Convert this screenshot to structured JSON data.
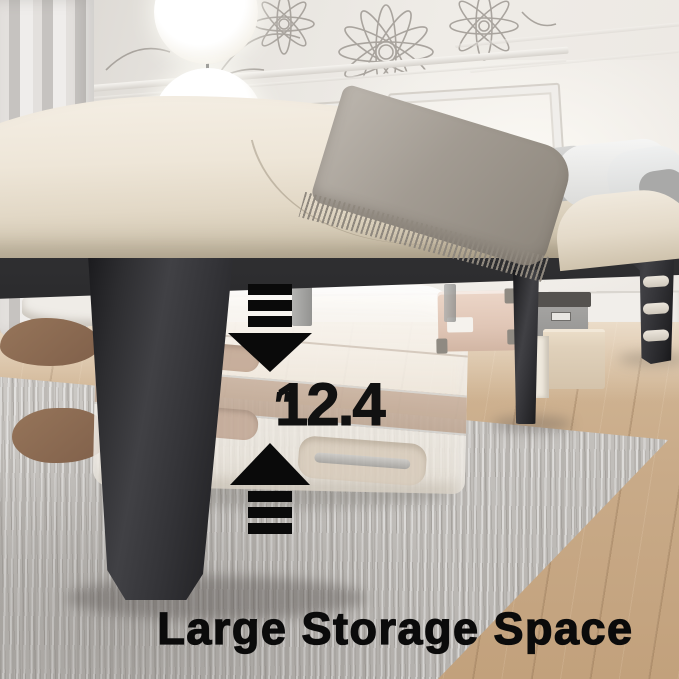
{
  "scene": {
    "description": "bedroom product photo of a black metal platform bed frame with under-bed storage"
  },
  "overlay": {
    "measurement_value": "12.4",
    "measurement_unit": "″",
    "caption": "Large Storage Space"
  },
  "icons": {
    "arrow_down": "arrow-down-icon",
    "arrow_up": "arrow-up-icon"
  },
  "palette": {
    "overlay_text_black": "#0b0b0b",
    "frame_black": "#2c2c2e",
    "mattress_cream": "#ece4d6",
    "wall_white": "#e9e6e1",
    "wood_floor": "#c9ab89",
    "rug_gray": "#cdcac6",
    "suitcase_white": "#f6f3ee",
    "suitcase_stripe_beige": "#c8b2a0",
    "throw_gray": "#968f85",
    "storage_box_pink": "#e0c6b6",
    "storage_box_gray": "#979694",
    "ottoman_beige": "#e0d1bb"
  }
}
